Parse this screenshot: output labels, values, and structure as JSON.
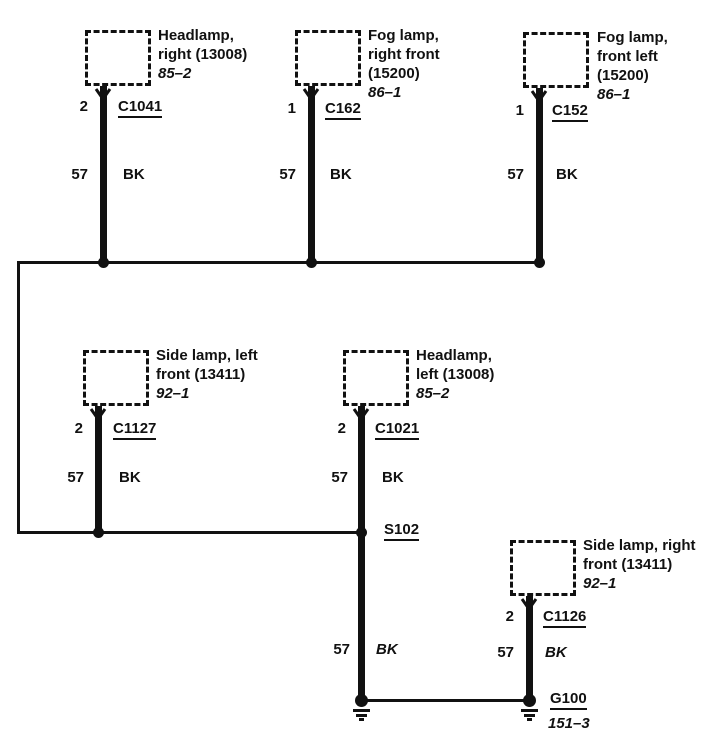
{
  "diagram_type": "automotive-ground-distribution-wiring-diagram",
  "colors": {
    "ink": "#111111",
    "background": "#ffffff"
  },
  "components": [
    {
      "name_lines": [
        "Headlamp,",
        "right (13008)"
      ],
      "page_ref": "85–2",
      "pin": "2",
      "connector": "C1041",
      "circuit": "57",
      "wire_color": "BK"
    },
    {
      "name_lines": [
        "Fog lamp,",
        "right front",
        "(15200)"
      ],
      "page_ref": "86–1",
      "pin": "1",
      "connector": "C162",
      "circuit": "57",
      "wire_color": "BK"
    },
    {
      "name_lines": [
        "Fog lamp,",
        "front left",
        "(15200)"
      ],
      "page_ref": "86–1",
      "pin": "1",
      "connector": "C152",
      "circuit": "57",
      "wire_color": "BK"
    },
    {
      "name_lines": [
        "Side lamp, left",
        "front (13411)"
      ],
      "page_ref": "92–1",
      "pin": "2",
      "connector": "C1127",
      "circuit": "57",
      "wire_color": "BK"
    },
    {
      "name_lines": [
        "Headlamp,",
        "left (13008)"
      ],
      "page_ref": "85–2",
      "pin": "2",
      "connector": "C1021",
      "circuit": "57",
      "wire_color": "BK"
    },
    {
      "name_lines": [
        "Side lamp, right",
        "front (13411)"
      ],
      "page_ref": "92–1",
      "pin": "2",
      "connector": "C1126",
      "circuit": "57",
      "wire_color": "BK"
    }
  ],
  "splice": {
    "label": "S102"
  },
  "splice_wire": {
    "circuit": "57",
    "wire_color": "BK"
  },
  "ground": {
    "label": "G100",
    "page_ref": "151–3"
  }
}
